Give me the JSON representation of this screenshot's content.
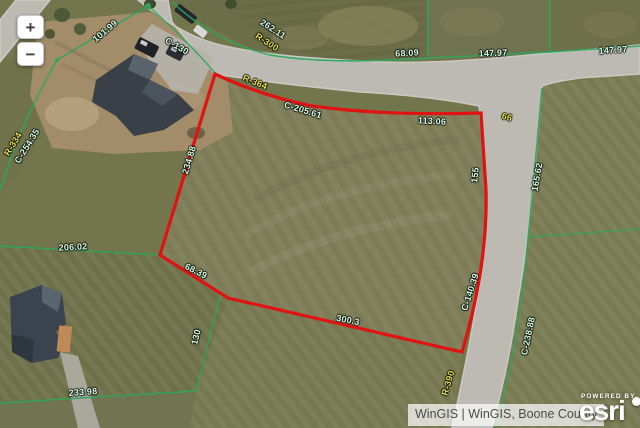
{
  "map_controls": {
    "zoom_in_label": "+",
    "zoom_out_label": "−"
  },
  "attribution": {
    "sources": "WinGIS | WinGIS, Boone County",
    "powered_by": "POWERED BY",
    "brand": "esri"
  },
  "colors": {
    "selected_parcel": "#e01212",
    "boundary_line": "#2ba75f",
    "dimension_text": "#d7ffe6",
    "radius_text": "#e8e14e"
  },
  "parcel_labels": [
    {
      "text": "101.99",
      "type": "dimension",
      "x": 105,
      "y": 31,
      "rot": -40
    },
    {
      "text": "C-130",
      "type": "dimension",
      "x": 177,
      "y": 46,
      "rot": 30
    },
    {
      "text": "262.11",
      "type": "dimension",
      "x": 273,
      "y": 29,
      "rot": 33
    },
    {
      "text": "R-300",
      "type": "radius",
      "x": 267,
      "y": 42,
      "rot": 33
    },
    {
      "text": "68.09",
      "type": "dimension",
      "x": 407,
      "y": 53,
      "rot": -3
    },
    {
      "text": "147.97",
      "type": "dimension",
      "x": 493,
      "y": 53,
      "rot": -2
    },
    {
      "text": "147.97",
      "type": "dimension",
      "x": 613,
      "y": 50,
      "rot": -4
    },
    {
      "text": "R-364",
      "type": "radius",
      "x": 255,
      "y": 82,
      "rot": 22
    },
    {
      "text": "C-205.61",
      "type": "dimension",
      "x": 303,
      "y": 110,
      "rot": 17
    },
    {
      "text": "113.06",
      "type": "dimension",
      "x": 432,
      "y": 121,
      "rot": 3
    },
    {
      "text": "66",
      "type": "radius",
      "x": 507,
      "y": 117,
      "rot": 15
    },
    {
      "text": "R-334",
      "type": "radius",
      "x": 13,
      "y": 144,
      "rot": -58
    },
    {
      "text": "C-254.35",
      "type": "dimension",
      "x": 27,
      "y": 146,
      "rot": -58
    },
    {
      "text": "234.88",
      "type": "dimension",
      "x": 189,
      "y": 160,
      "rot": -73
    },
    {
      "text": "206.02",
      "type": "dimension",
      "x": 73,
      "y": 247,
      "rot": -3
    },
    {
      "text": "68.39",
      "type": "dimension",
      "x": 196,
      "y": 271,
      "rot": 27
    },
    {
      "text": "155",
      "type": "dimension",
      "x": 475,
      "y": 175,
      "rot": -84
    },
    {
      "text": "165.62",
      "type": "dimension",
      "x": 537,
      "y": 177,
      "rot": -80
    },
    {
      "text": "C-140.39",
      "type": "dimension",
      "x": 470,
      "y": 292,
      "rot": -72
    },
    {
      "text": "C-238.88",
      "type": "dimension",
      "x": 528,
      "y": 336,
      "rot": -78
    },
    {
      "text": "R-390",
      "type": "radius",
      "x": 448,
      "y": 383,
      "rot": -73
    },
    {
      "text": "300.3",
      "type": "dimension",
      "x": 348,
      "y": 320,
      "rot": 11
    },
    {
      "text": "130",
      "type": "dimension",
      "x": 196,
      "y": 337,
      "rot": -76
    },
    {
      "text": "233.98",
      "type": "dimension",
      "x": 83,
      "y": 392,
      "rot": -4
    }
  ]
}
